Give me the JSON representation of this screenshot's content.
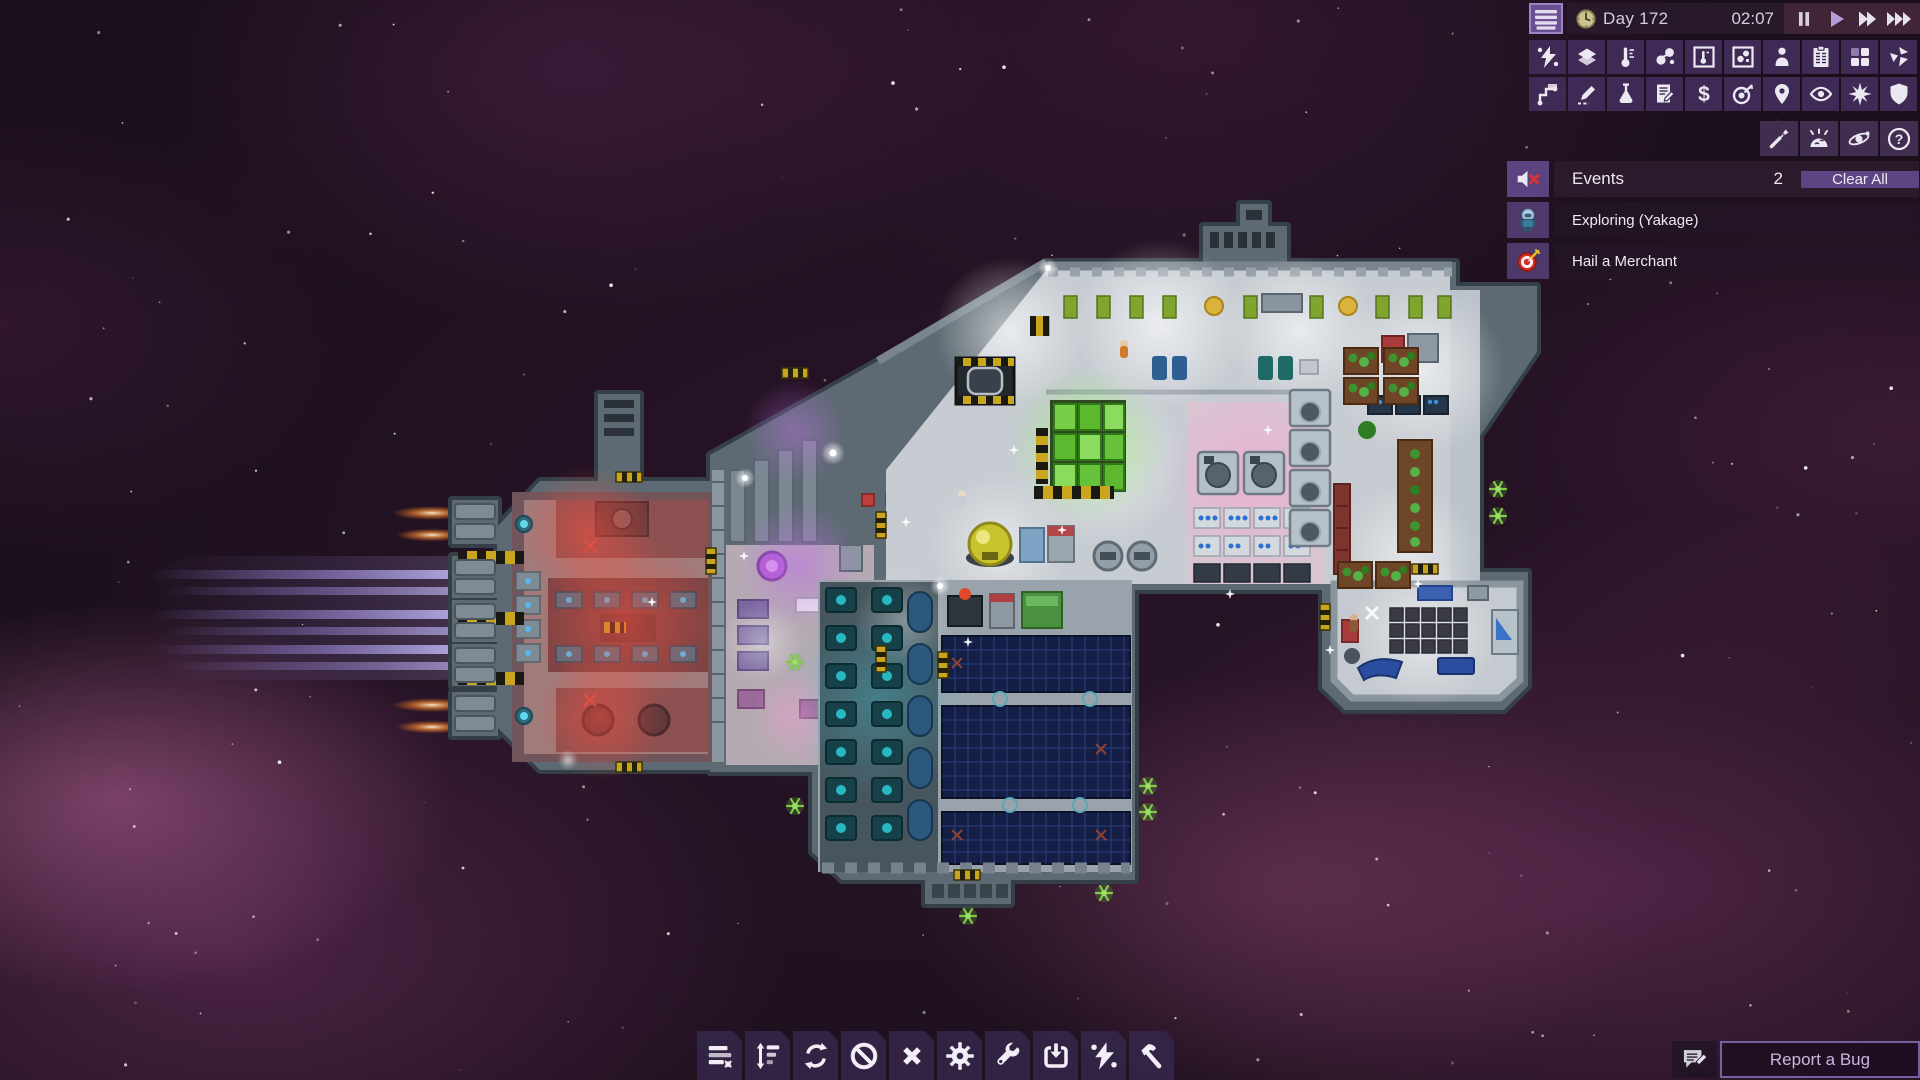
{
  "topbar": {
    "day": "Day 172",
    "time": "02:07",
    "menu_icon": "hamburger-icon",
    "clock_icon": "clock-icon",
    "speed_controls": [
      {
        "id": "pause",
        "icon": "pause-icon",
        "active": false
      },
      {
        "id": "play",
        "icon": "play-icon",
        "active": true
      },
      {
        "id": "fast-forward",
        "icon": "fast-forward-icon",
        "active": false
      },
      {
        "id": "fastest",
        "icon": "fastest-icon",
        "active": false
      }
    ]
  },
  "overlay_toolbar": {
    "row1": [
      "power",
      "tiles",
      "temperature",
      "gas",
      "temperature-view",
      "gas-view",
      "crew",
      "tasks",
      "modules",
      "damage"
    ],
    "row2": [
      "logistics",
      "plan",
      "research",
      "contracts",
      "trade",
      "missions",
      "navigation",
      "view",
      "combat",
      "shield"
    ]
  },
  "quick_toolbar": [
    "dart",
    "meteor",
    "orbit",
    "help"
  ],
  "events_panel": {
    "title": "Events",
    "count": "2",
    "clear_all_label": "Clear All",
    "mute_icon": "muted-speaker-icon",
    "items": [
      {
        "icon": "explorer-crew-icon",
        "label": "Exploring (Yakage)"
      },
      {
        "icon": "target-dart-icon",
        "label": "Hail a Merchant"
      }
    ]
  },
  "build_toolbar": [
    "manage-list",
    "priority",
    "rotate",
    "forbid",
    "deconstruct",
    "settings",
    "repair",
    "install",
    "power",
    "build"
  ],
  "report_bug": {
    "label": "Report a Bug",
    "icon": "chat-pencil-icon"
  },
  "ship": {
    "sections": [
      "engine-wing",
      "medbay",
      "main-deck",
      "hydroponics-farm",
      "grow-beds",
      "solar-array",
      "workshop",
      "storage-bay"
    ],
    "colors": {
      "hull": "#5d6a73",
      "engine_trail": "#9b8ce0",
      "thruster_flame": "#ffae5a",
      "red_rooms": "#8d5050",
      "medbay_glow": "#c070e8",
      "farm_green": "#66c23a",
      "solar_panels": "#151f45",
      "teal_machines": "#164149",
      "maneuver_thruster": "#7ecb44"
    }
  },
  "hud_colors": {
    "accent_purple": "#6a4f93",
    "panel_bg": "#2a1b2e",
    "cell_bg": "#3e2a54",
    "events_row_bg": "#221424",
    "clear_button_bg": "#5d4483",
    "report_text": "#c9b6dd"
  }
}
